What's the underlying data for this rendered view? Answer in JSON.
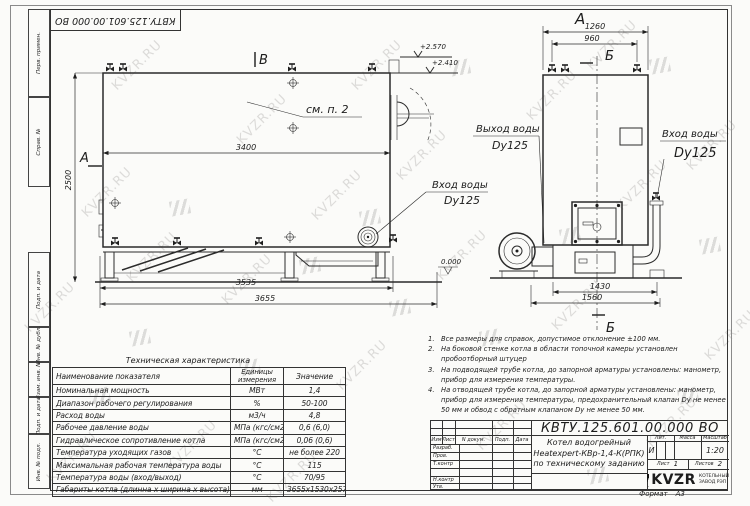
{
  "watermark": {
    "text": "KVZR.RU",
    "color": "#c3c2c0",
    "text_positions": [
      [
        18,
        300
      ],
      [
        75,
        185
      ],
      [
        40,
        450
      ],
      [
        105,
        58
      ],
      [
        230,
        112
      ],
      [
        215,
        272
      ],
      [
        160,
        438
      ],
      [
        305,
        188
      ],
      [
        330,
        358
      ],
      [
        345,
        58
      ],
      [
        430,
        248
      ],
      [
        470,
        418
      ],
      [
        520,
        88
      ],
      [
        545,
        298
      ],
      [
        610,
        178
      ],
      [
        640,
        415
      ],
      [
        680,
        138
      ],
      [
        698,
        328
      ],
      [
        390,
        148
      ],
      [
        580,
        38
      ],
      [
        260,
        470
      ],
      [
        120,
        250
      ]
    ],
    "logo_positions": [
      [
        170,
        200
      ],
      [
        300,
        258
      ],
      [
        450,
        60
      ],
      [
        560,
        228
      ],
      [
        650,
        58
      ],
      [
        390,
        300
      ],
      [
        240,
        360
      ],
      [
        678,
        388
      ],
      [
        130,
        330
      ],
      [
        480,
        330
      ],
      [
        588,
        468
      ],
      [
        90,
        388
      ],
      [
        700,
        238
      ],
      [
        360,
        210
      ]
    ]
  },
  "corner_stamp": {
    "doc_number": "КВТУ.125.601.00.000  ВО"
  },
  "margin_labels": {
    "perv": "Перв. примен.",
    "sprav": "Справ. №",
    "podp1": "Подп. и дата",
    "inv_dubl": "Инв. № дубл.",
    "vzam": "Взам. инв. №",
    "podp2": "Подп. и дата",
    "inv_podl": "Инв. № подл."
  },
  "side_view": {
    "section_top": "В",
    "section_left": "А",
    "section_right": "В",
    "note_ref": "см. п. 2",
    "elev_high": "+2.570",
    "elev_low": "+2.410",
    "elev_zero": "0.000",
    "dim_width_inner": "3400",
    "dim_height": "2500",
    "dim_base": "3535",
    "dim_total": "3655",
    "inlet_label": "Вход воды",
    "inlet_size": "Dy125"
  },
  "front_view": {
    "view_label": "А",
    "section_mark_top": "Б",
    "section_mark_bottom": "Б",
    "dim_top_outer": "1260",
    "dim_top_inner": "960",
    "dim_base_inner": "1430",
    "dim_base_outer": "1560",
    "outlet_label": "Выход воды",
    "outlet_size": "Dy125",
    "inlet_label": "Вход воды",
    "inlet_size": "Dy125"
  },
  "notes": [
    {
      "num": "1.",
      "text": "Все размеры для справок, допустимое отклонение ±100 мм."
    },
    {
      "num": "2.",
      "text": "На боковой стенке котла в области топочной камеры установлен пробоотборный штуцер"
    },
    {
      "num": "3.",
      "text": "На подводящей трубе котла, до запорной арматуры установлены: манометр, прибор для измерения температуры."
    },
    {
      "num": "4.",
      "text": "На отводящей трубе котла, до запорной арматуры установлены: манометр, прибор для измерения температуры, предохранительный клапан Dу не менее 50 мм и обвод с обратным клапаном Dу не менее 50 мм."
    }
  ],
  "spec_table": {
    "title": "Техническая характеристика",
    "headers": [
      "Наименование показателя",
      "Единицы измерения",
      "Значение"
    ],
    "rows": [
      [
        "Номинальная мощность",
        "МВт",
        "1,4"
      ],
      [
        "Диапазон рабочего регулирования",
        "%",
        "50-100"
      ],
      [
        "Расход воды",
        "м3/ч",
        "4,8"
      ],
      [
        "Рабочее давление воды",
        "МПа (кгс/см2)",
        "0,6 (6,0)"
      ],
      [
        "Гидравлическое сопротивление котла",
        "МПа (кгс/см2)",
        "0,06 (0,6)"
      ],
      [
        "Температура уходящих газов",
        "°С",
        "не более 220"
      ],
      [
        "Максимальная рабочая температура воды",
        "°С",
        "115"
      ],
      [
        "Температура воды (вход/выход)",
        "°С",
        "70/95"
      ],
      [
        "Габариты котла (длинна х ширина х высота)",
        "мм",
        "3655х1530х2570"
      ]
    ]
  },
  "title_block": {
    "doc_number": "КВТУ.125.601.00.000  ВО",
    "product_line1": "Котел водогрейный",
    "product_line2": "Heatexpert-КВр-1,4-К(РПК)",
    "product_line3": "по техническому заданию",
    "header_cols": [
      "Изм",
      "Лист",
      "N докум.",
      "Подп.",
      "Дата"
    ],
    "row_labels": [
      "Разраб.",
      "Пров.",
      "Т.контр",
      "",
      "Н.контр",
      "Утв."
    ],
    "lit_header": "Лит.",
    "lit_value": "И",
    "mass_header": "Масса",
    "scale_header": "Масштаб",
    "scale_value": "1:20",
    "sheet_label": "Лист",
    "sheet_value": "1",
    "sheets_label": "Листов",
    "sheets_value": "2",
    "company_logo": "KVZR",
    "company_name1": "КОТЕЛЬНЫЙ",
    "company_name2": "ЗАВОД РЭП",
    "format_label": "Формат",
    "format_value": "А3"
  }
}
